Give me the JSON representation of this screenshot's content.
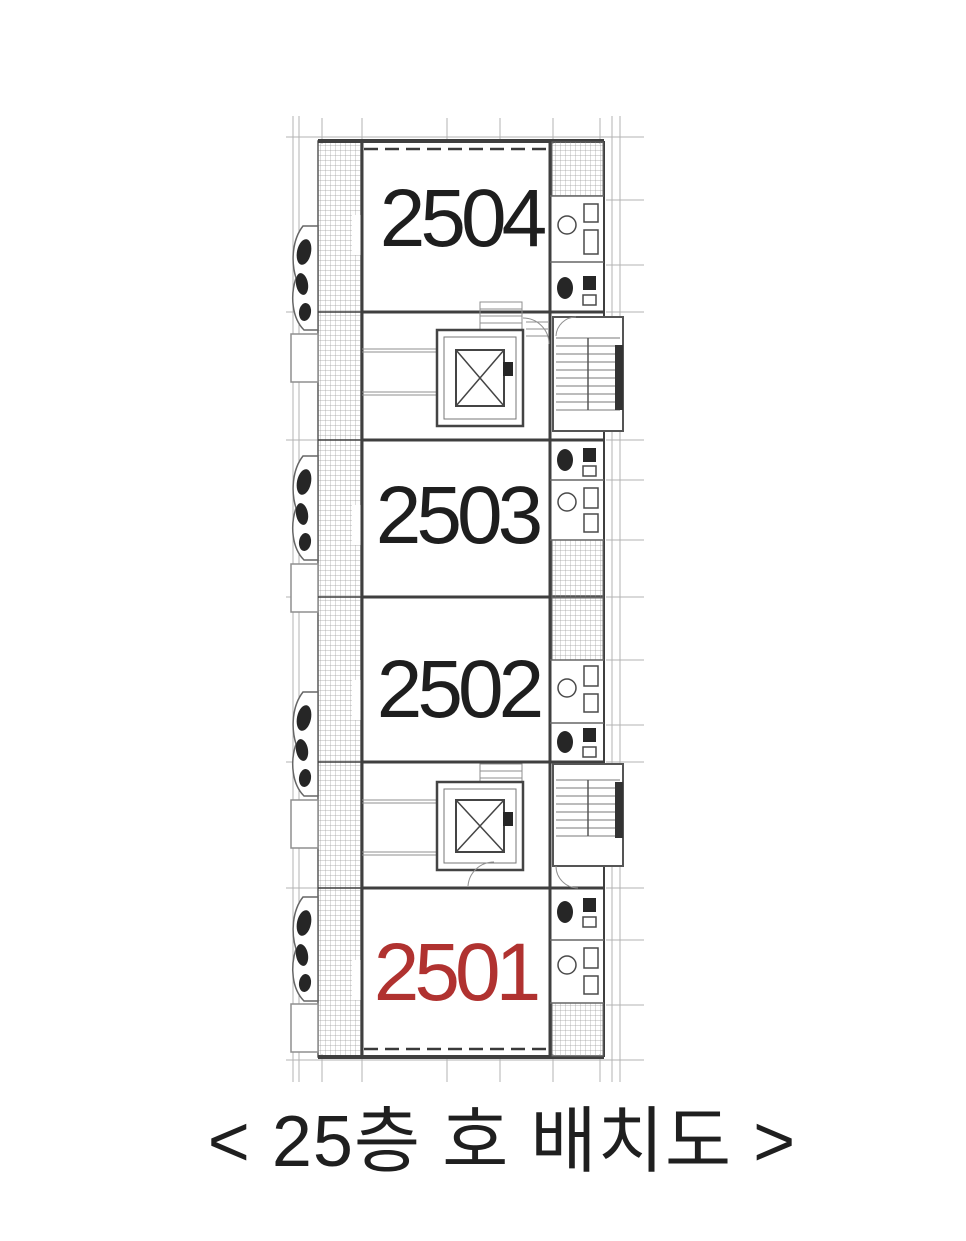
{
  "page": {
    "background": "#ffffff"
  },
  "plan": {
    "caption": "< 25층 호 배치도 >",
    "caption_color": "#1f1f1f",
    "highlight_color": "#b03230",
    "units": [
      {
        "number": "2504",
        "color": "#1e1e1e",
        "highlighted": false
      },
      {
        "number": "2503",
        "color": "#1e1e1e",
        "highlighted": false
      },
      {
        "number": "2502",
        "color": "#1e1e1e",
        "highlighted": false
      },
      {
        "number": "2501",
        "color": "#b03230",
        "highlighted": true
      }
    ],
    "drawing_colors": {
      "wall": "#3f3f3f",
      "thin_line": "#8f8f8f",
      "hatch": "#9c9c9c",
      "fixture": "#262626"
    }
  }
}
